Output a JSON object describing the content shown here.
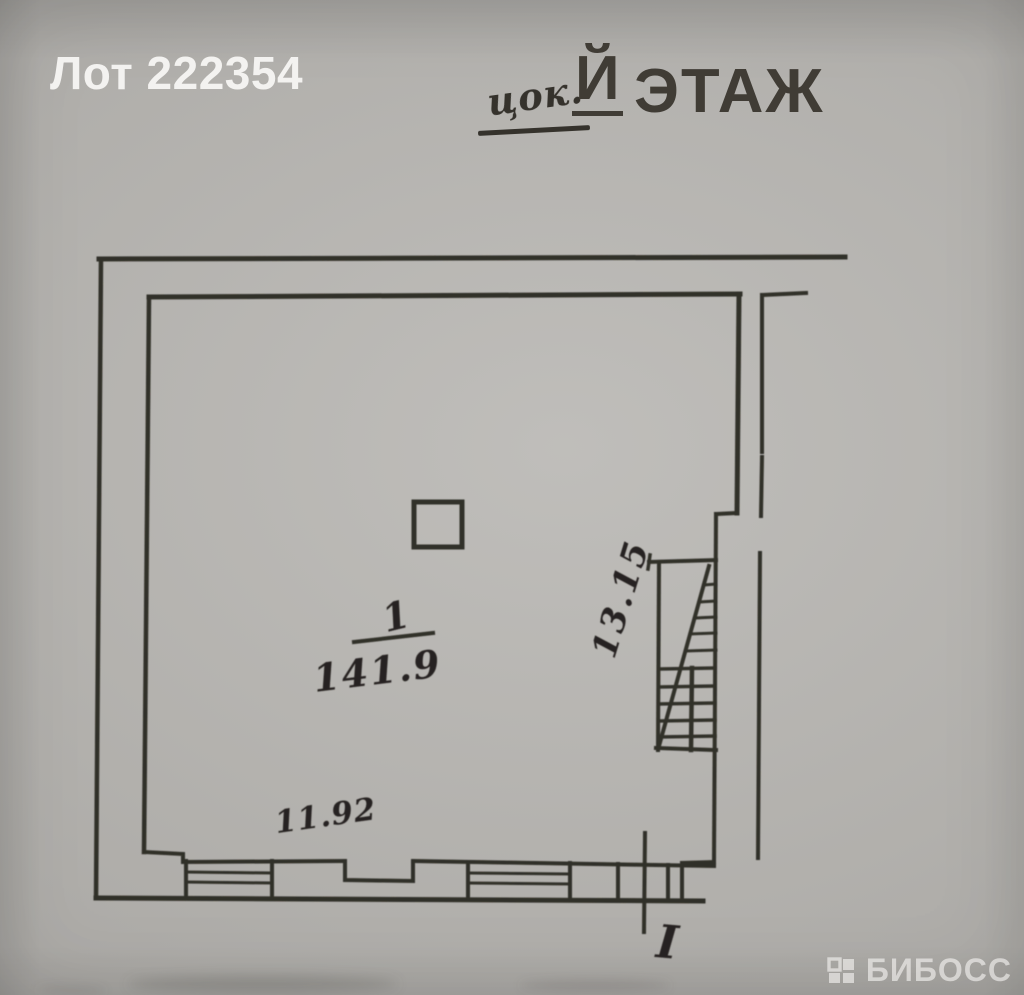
{
  "lot": {
    "label": "Лот 222354"
  },
  "title": {
    "handwritten_prefix": "цок.",
    "suffix_letter": "Й",
    "word": "ЭТАЖ"
  },
  "plan": {
    "room": {
      "number": "1",
      "area": "141.9"
    },
    "dimensions": {
      "bottom_width": "11.92",
      "right_height": "13.15"
    },
    "entrance_mark": "I"
  },
  "watermark": {
    "brand": "БИБОСС"
  },
  "colors": {
    "ink": "#2c2923",
    "paper": "#b5b3af",
    "lot_label_text": "#f6f5f3",
    "watermark_text": "#fbfaf8"
  }
}
